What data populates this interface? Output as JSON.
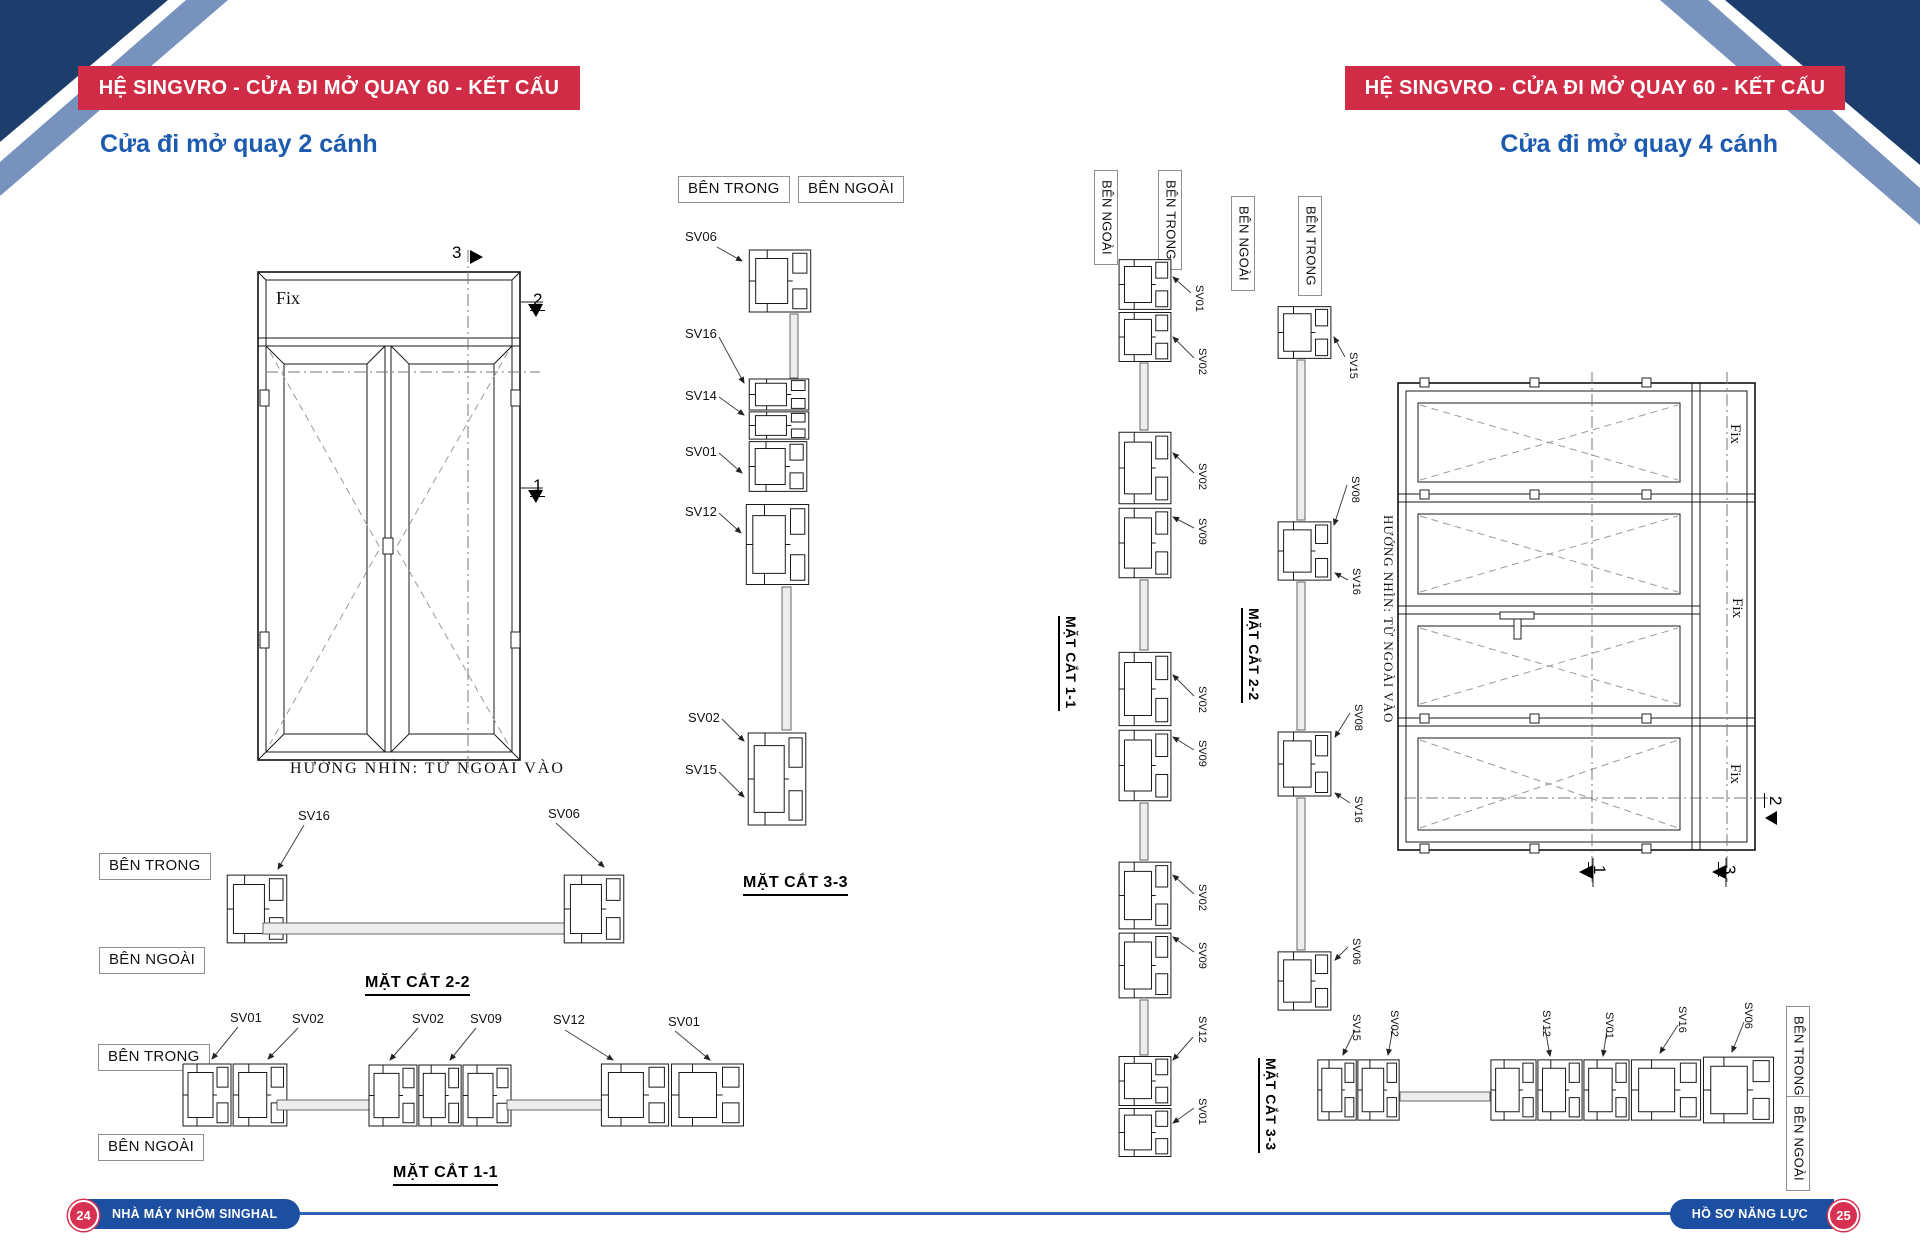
{
  "colors": {
    "banner_red": "#d02c46",
    "title_blue": "#1d5bb0",
    "footer_navy": "#1c4fa1",
    "footer_line_blue": "#2b62b4",
    "corner_navy": "#1d3e6d",
    "corner_steel_blue": "#7792bd",
    "page_number_red": "#d83050"
  },
  "header": {
    "left_banner": "HỆ SINGVRO - CỬA ĐI MỞ QUAY 60 - KẾT CẤU",
    "right_banner": "HỆ SINGVRO - CỬA ĐI MỞ QUAY 60 - KẾT CẤU"
  },
  "left_page": {
    "title": "Cửa đi mở quay 2 cánh",
    "elevation": {
      "fix_label": "Fix",
      "caption": "HƯỚNG NHÌN: TỪ NGOÀI VÀO",
      "markers": [
        "3",
        "2",
        "1"
      ]
    },
    "section33": {
      "inside": "BÊN TRONG",
      "outside": "BÊN NGOÀI",
      "labels": [
        "SV06",
        "SV16",
        "SV14",
        "SV01",
        "SV12",
        "SV02",
        "SV15"
      ],
      "caption": "MẶT CẮT 3-3"
    },
    "section22": {
      "inside": "BÊN TRONG",
      "outside": "BÊN NGOÀI",
      "labels": [
        "SV16",
        "SV06"
      ],
      "caption": "MẶT CẮT 2-2"
    },
    "section11": {
      "inside": "BÊN TRONG",
      "outside": "BÊN NGOÀI",
      "labels": [
        "SV01",
        "SV02",
        "SV02",
        "SV09",
        "SV12",
        "SV01"
      ],
      "caption": "MẶT CẮT 1-1"
    }
  },
  "right_page": {
    "title": "Cửa đi mở quay 4 cánh",
    "section11": {
      "outside": "BÊN NGOÀI",
      "inside": "BÊN TRONG",
      "labels": [
        "SV01",
        "SV02",
        "SV02",
        "SV09",
        "SV02",
        "SV09",
        "SV02",
        "SV09",
        "SV12",
        "SV01"
      ],
      "caption": "MẶT CẮT 1-1"
    },
    "section22": {
      "outside": "BÊN NGOÀI",
      "inside": "BÊN TRONG",
      "labels": [
        "SV15",
        "SV08",
        "SV16",
        "SV08",
        "SV16",
        "SV06"
      ],
      "caption": "MẶT CẮT 2-2"
    },
    "elevation": {
      "fix_labels": [
        "Fix",
        "Fix",
        "Fix"
      ],
      "caption": "HƯỚNG NHÌN: TỪ NGOÀI VÀO",
      "markers": [
        "2",
        "1",
        "3"
      ]
    },
    "section33": {
      "labels": [
        "SV15",
        "SV02",
        "SV12",
        "SV01",
        "SV16",
        "SV06"
      ],
      "caption": "MẶT CẮT 3-3",
      "inside": "BÊN TRONG",
      "outside": "BÊN NGOÀI"
    }
  },
  "footer": {
    "left_page_number": "24",
    "left_text": "NHÀ MÁY NHÔM SINGHAL",
    "right_text": "HỒ SƠ NĂNG LỰC",
    "right_page_number": "25"
  }
}
